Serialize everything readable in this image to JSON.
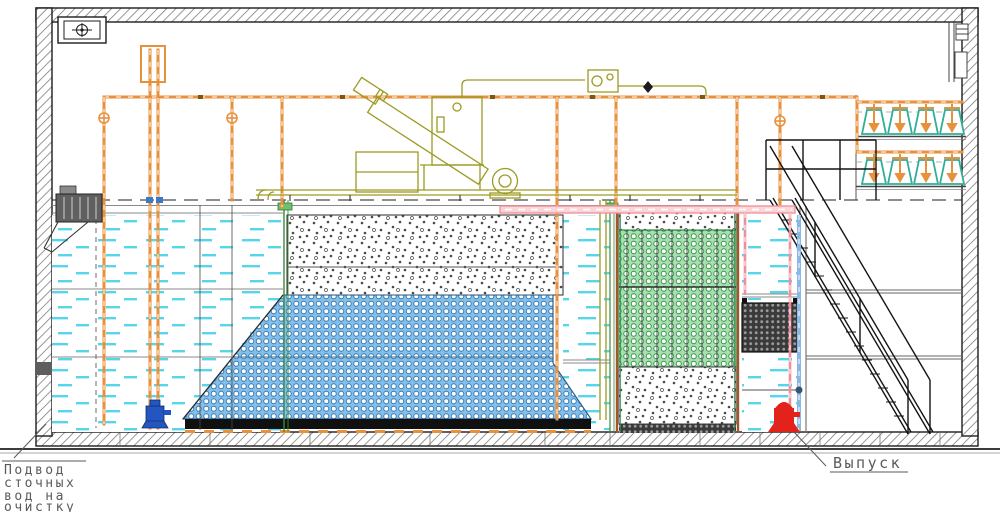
{
  "drawing": {
    "kind": "wastewater-treatment-plant-cross-section",
    "labels": {
      "inlet": {
        "line1": "Подвод",
        "line2": "сточных",
        "line3": "вод на",
        "line4": "очистку"
      },
      "outlet": "Выпуск"
    },
    "colors": {
      "pipe_orange": "#E8913D",
      "equipment_olive": "#9C9B23",
      "media_green_bg": "#A8DFAF",
      "media_green_line": "#2F9147",
      "media_blue_bg": "#85BFE8",
      "media_blue_line": "#2F77B5",
      "water_cyan": "#56D6E8",
      "overflow_pink": "#EE8F9C",
      "pump_red": "#E3221B",
      "pump_blue": "#2356C0",
      "blower_teal": "#2FAE98",
      "hatch_gray": "#7d7d7d"
    },
    "symbols": {
      "ventilation_unit": "fan-box-icon",
      "inlet_screen_drive": "motor-icon",
      "screw_conveyor": "inclined-conveyor-icon",
      "control_cabinet": "cabinet-icon",
      "blower": "air-blower-icon",
      "valve": "circle-cross-valve-icon",
      "stairs": "service-stairs-icon"
    }
  }
}
